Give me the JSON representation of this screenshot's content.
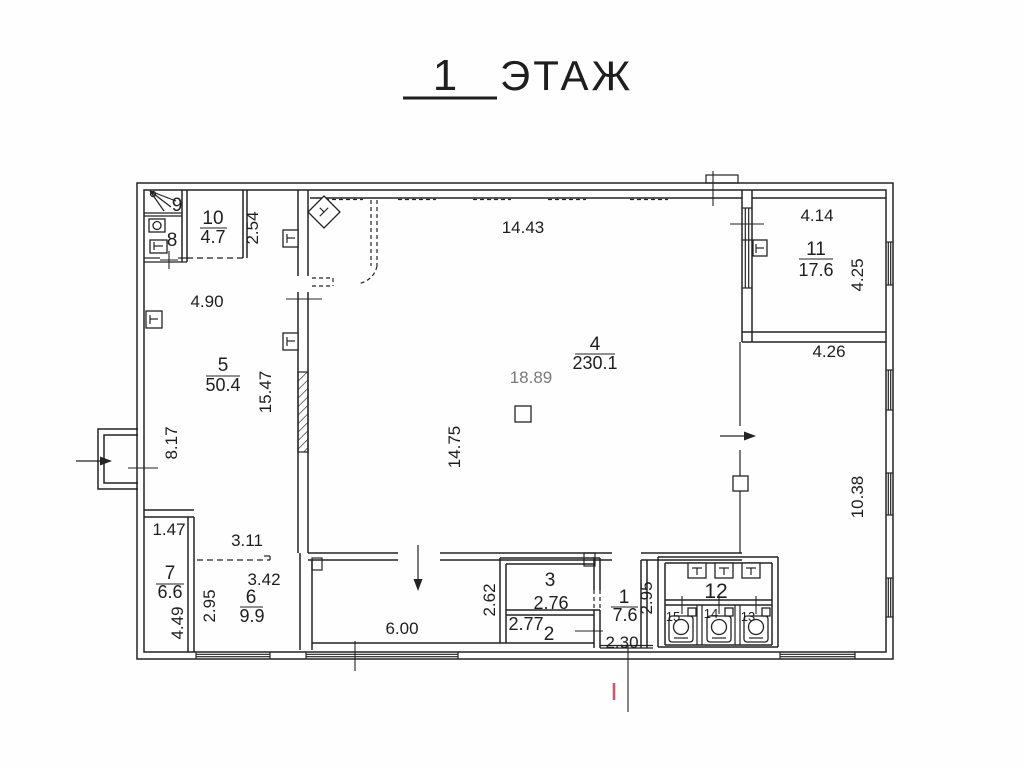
{
  "title": {
    "number": "1",
    "word": "ЭТАЖ"
  },
  "colors": {
    "line": "#232323",
    "red_mark": "#c9566f",
    "dim_gray": "#7a7a7a"
  },
  "rooms": {
    "r1": {
      "number": "1",
      "area": "7.6"
    },
    "r2": {
      "number": "2",
      "area": "2.77"
    },
    "r3": {
      "number": "3",
      "area": "2.76"
    },
    "r4": {
      "number": "4",
      "area": "230.1"
    },
    "r5": {
      "number": "5",
      "area": "50.4"
    },
    "r6": {
      "number": "6",
      "area": "9.9"
    },
    "r7": {
      "number": "7",
      "area": "6.6"
    },
    "r8": {
      "number": "8"
    },
    "r9": {
      "number": "9"
    },
    "r10": {
      "number": "10",
      "area": "4.7"
    },
    "r11": {
      "number": "11",
      "area": "17.6"
    },
    "r12": {
      "number": "12"
    },
    "r13": {
      "number": "13"
    },
    "r14": {
      "number": "14"
    },
    "r15": {
      "number": "15"
    }
  },
  "dimensions": {
    "room10_strip": "2.54",
    "room5_width": "4.90",
    "room5_height": "15.47",
    "room5_lower_height": "8.17",
    "room4_width": "14.43",
    "room4_inner_width": "18.89",
    "room4_height": "14.75",
    "room11_width": "4.14",
    "room11_height": "4.25",
    "right_zone_width": "4.26",
    "right_zone_height": "10.38",
    "room7_width": "1.47",
    "room6_opening": "3.11",
    "room6_width": "3.42",
    "room6_height": "2.95",
    "room7_height": "4.49",
    "corridor_length": "6.00",
    "corridor_width": "2.62",
    "room1_door": "2.30",
    "room12_height": "2.95"
  }
}
